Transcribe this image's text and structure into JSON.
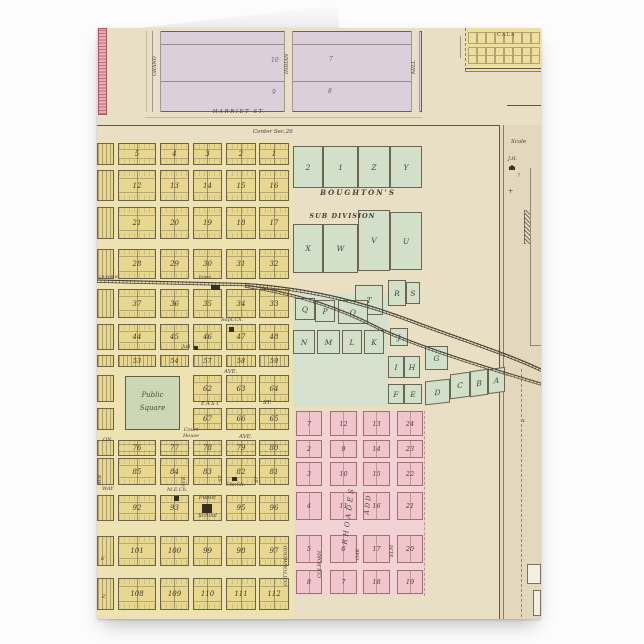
{
  "map": {
    "top_section": {
      "harriet": "HARRIET ST.",
      "grand": "GRAND",
      "indian": "INDIAN",
      "mill": "MILL",
      "blocks": [
        "10",
        "7",
        "9",
        "8"
      ]
    },
    "center_label": "Center Sec.26",
    "inset_title": "CALA",
    "railroad": {
      "label": "J.B.W.R.R.",
      "depot": "Depot"
    },
    "yellow": {
      "rows": [
        [
          "5",
          "4",
          "3",
          "2",
          "1"
        ],
        [
          "12",
          "13",
          "14",
          "15",
          "16"
        ],
        [
          "21",
          "20",
          "19",
          "18",
          "17"
        ],
        [
          "28",
          "29",
          "30",
          "31",
          "32"
        ],
        [
          "37",
          "36",
          "35",
          "34",
          "33"
        ],
        [
          "44",
          "45",
          "46",
          "47",
          "48"
        ],
        [
          "53",
          "54",
          "57",
          "58",
          "59"
        ],
        [
          "62",
          "63",
          "64"
        ],
        [
          "67",
          "66",
          "65"
        ],
        [
          "76",
          "77",
          "78",
          "79",
          "80"
        ],
        [
          "85",
          "84",
          "83",
          "82",
          "81"
        ],
        [
          "92",
          "93",
          "",
          "95",
          "96"
        ],
        [
          "101",
          "100",
          "99",
          "98",
          "97"
        ],
        [
          "108",
          "109",
          "110",
          "111",
          "112"
        ]
      ]
    },
    "green": {
      "title1": "BOUGHTON'S",
      "title2": "SUB DIVISION",
      "row1": [
        "2",
        "1",
        "Z",
        "Y"
      ],
      "row2": [
        "X",
        "W",
        "V",
        "U"
      ],
      "letters": {
        "t": "T",
        "r": "R",
        "s": "S",
        "q": "Q",
        "p": "P",
        "o": "O",
        "n": "N",
        "m": "M",
        "l": "L",
        "k": "K",
        "j": "J",
        "i": "I",
        "h": "H",
        "g": "G",
        "f": "F",
        "e": "E",
        "d": "D",
        "c": "C",
        "b": "B",
        "a": "A"
      }
    },
    "pink": {
      "title1": "RHOADES",
      "title2": "ADD",
      "rows": [
        [
          "7",
          "12",
          "13",
          "24"
        ],
        [
          "2",
          "9",
          "14",
          "23"
        ],
        [
          "3",
          "10",
          "15",
          "22"
        ],
        [
          "4",
          "11",
          "16",
          "21"
        ],
        [
          "5",
          "6",
          "17",
          "20"
        ],
        [
          "8",
          "7",
          "18",
          "19"
        ]
      ]
    },
    "streets": {
      "ave": "AVE.",
      "ave_short": "AVE",
      "east": "EAST",
      "st": "ST.",
      "st_short": "ST",
      "way": "WAY",
      "on": "ON",
      "e": "E",
      "z": "Z",
      "cottonwood": "COTTONWOOD",
      "colborn": "COLBORN",
      "oak": "OAK",
      "elm": "ELM"
    },
    "landmarks": {
      "public_square": [
        "Public",
        "Square"
      ],
      "court_house": [
        "Court",
        "House"
      ],
      "bapt_ch": "Bapt.Ch.",
      "jail": "Jail",
      "me_ch": "M.E.Ch.",
      "chr_ch": "Chr.Ch.",
      "school": [
        "Public",
        "School"
      ]
    },
    "right_margin": {
      "scale": "Scale",
      "jh": "J.H.",
      "seven": "7",
      "plus": "+",
      "x": "x"
    }
  }
}
